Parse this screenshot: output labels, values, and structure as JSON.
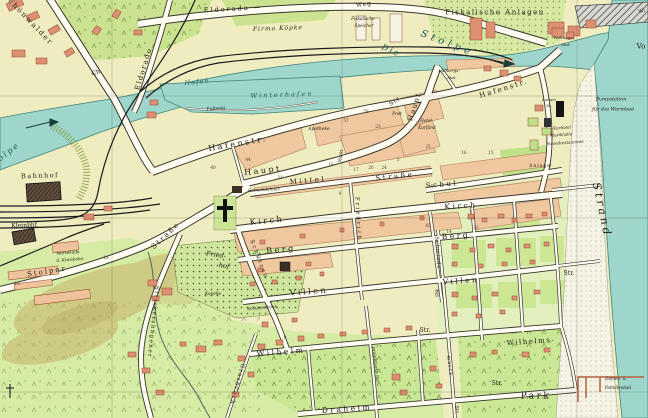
{
  "map": {
    "colors": {
      "land": "#efecc0",
      "water": "#9fd6cc",
      "park_green": "#cbe390",
      "meadow_green": "#d6eba4",
      "building_block": "#f0c8a0",
      "house_red": "#dd8f72",
      "beach": "#f6f3e4",
      "hill_tan": "#c8b26a",
      "rail_black": "#1c1c1c"
    },
    "labels": [
      {
        "t": "Schönwalder",
        "x": 28,
        "y": 20,
        "s": 7,
        "r": 46,
        "ls": 2,
        "n": "label-schoenwalder-ch"
      },
      {
        "t": "Ch.",
        "x": 97,
        "y": 73,
        "s": 6,
        "r": -20,
        "n": "label-chaussee-abbrev"
      },
      {
        "t": "Eldorado",
        "x": 144,
        "y": 69,
        "s": 7,
        "r": -73,
        "ls": 1.5,
        "n": "label-eldorado-street"
      },
      {
        "t": "Eldorado —",
        "x": 233,
        "y": 9,
        "s": 6.5,
        "r": -3,
        "ls": 2,
        "n": "label-eldoradoweg-1"
      },
      {
        "t": "Weg",
        "x": 364,
        "y": 5,
        "s": 6,
        "r": -8,
        "ls": 1,
        "n": "label-eldoradoweg-2"
      },
      {
        "t": "Firma Köpke",
        "x": 278,
        "y": 29,
        "s": 6,
        "r": -2,
        "c": "it",
        "ls": 1,
        "n": "label-firma-koepke"
      },
      {
        "t": "Fiskalische",
        "x": 363,
        "y": 19,
        "s": 4.2,
        "c": "it",
        "n": "label-fisk-speicher-1"
      },
      {
        "t": "Speicher",
        "x": 364,
        "y": 26,
        "s": 4.2,
        "c": "it",
        "n": "label-fisk-speicher-2"
      },
      {
        "t": "Fiskalische Anlagen",
        "x": 495,
        "y": 13,
        "s": 7,
        "ls": 1.5,
        "n": "label-fiskalische-anlagen"
      },
      {
        "t": "Rettungs-",
        "x": 564,
        "y": 38,
        "s": 4,
        "c": "it",
        "n": "label-rettungs-stat-1"
      },
      {
        "t": "Stat.",
        "x": 566,
        "y": 45,
        "s": 4,
        "c": "it",
        "n": "label-rettungs-stat-2"
      },
      {
        "t": "Wi",
        "x": 642,
        "y": 12,
        "s": 5,
        "r": -15,
        "n": "label-edge-wi"
      },
      {
        "t": "Vo",
        "x": 641,
        "y": 47,
        "s": 7,
        "n": "label-edge-vo"
      },
      {
        "t": "Die",
        "x": 391,
        "y": 51,
        "s": 8,
        "r": 24,
        "c": "wat",
        "ls": 2,
        "n": "label-die-stolpe-1"
      },
      {
        "t": "Stolpe",
        "x": 447,
        "y": 44,
        "s": 10,
        "r": 21,
        "c": "wat",
        "ls": 4,
        "n": "label-die-stolpe-2"
      },
      {
        "t": "Hallbergs-",
        "x": 449,
        "y": 71,
        "s": 4,
        "c": "it",
        "n": "label-hallbergs-stat-1"
      },
      {
        "t": "Stat.",
        "x": 452,
        "y": 78,
        "s": 4,
        "c": "it",
        "n": "label-hallbergs-stat-2"
      },
      {
        "t": "Hafenstr.",
        "x": 504,
        "y": 89,
        "s": 7,
        "r": -17,
        "ls": 2,
        "n": "label-hafenstr-east"
      },
      {
        "t": "Stolpe",
        "x": 4,
        "y": 156,
        "s": 8,
        "r": -38,
        "c": "wat",
        "ls": 2,
        "n": "label-stolpe-west"
      },
      {
        "t": "Hafen",
        "x": 197,
        "y": 82,
        "s": 6.5,
        "r": -6,
        "c": "wat",
        "ls": 1,
        "n": "label-hafen"
      },
      {
        "t": "Winterhafen",
        "x": 282,
        "y": 95,
        "s": 6.5,
        "r": -2,
        "c": "wat",
        "ls": 2,
        "n": "label-winterhafen"
      },
      {
        "t": "Fußweg",
        "x": 216,
        "y": 110,
        "s": 4.5,
        "r": -4,
        "n": "label-fussweg"
      },
      {
        "t": "Hafenstr.",
        "x": 238,
        "y": 144,
        "s": 8,
        "r": -10,
        "ls": 2.5,
        "n": "label-hafenstr-west"
      },
      {
        "t": "Haupt",
        "x": 263,
        "y": 171,
        "s": 8,
        "r": -7,
        "ls": 2.5,
        "n": "label-hauptstr-west"
      },
      {
        "t": "Str.",
        "x": 396,
        "y": 101,
        "s": 6,
        "r": -35,
        "ls": 1,
        "n": "label-str-ne"
      },
      {
        "t": "Haupt",
        "x": 415,
        "y": 107,
        "s": 7,
        "r": -72,
        "ls": 1.5,
        "n": "label-hauptstr-ne"
      },
      {
        "t": "Post",
        "x": 397,
        "y": 115,
        "s": 4.5,
        "c": "it",
        "n": "label-post"
      },
      {
        "t": "Apotheke",
        "x": 319,
        "y": 130,
        "s": 4.5,
        "c": "it",
        "n": "label-apotheke"
      },
      {
        "t": "Hotel",
        "x": 426,
        "y": 121,
        "s": 4.2,
        "c": "it",
        "n": "label-hotel-1"
      },
      {
        "t": "Kurfürst",
        "x": 427,
        "y": 128,
        "s": 4.2,
        "c": "it",
        "n": "label-hotel-2"
      },
      {
        "t": "Markt",
        "x": 341,
        "y": 156,
        "s": 4.2,
        "r": -80,
        "n": "label-markt"
      },
      {
        "t": "Gemeindehaus",
        "x": 264,
        "y": 190,
        "s": 4.2,
        "r": -3,
        "c": "it",
        "n": "label-gemeindehaus"
      },
      {
        "t": "Mittel",
        "x": 308,
        "y": 181,
        "s": 7,
        "r": -5,
        "ls": 2.5,
        "n": "label-mittelstr-1"
      },
      {
        "t": "Straße",
        "x": 395,
        "y": 177,
        "s": 7,
        "r": -6,
        "ls": 2.5,
        "n": "label-mittelstr-2"
      },
      {
        "t": "Schul",
        "x": 442,
        "y": 185,
        "s": 7,
        "r": -5,
        "ls": 2.5,
        "n": "label-schulstr"
      },
      {
        "t": "Kirch",
        "x": 267,
        "y": 221,
        "s": 8,
        "r": -6,
        "ls": 2.5,
        "n": "label-kirchstr-west"
      },
      {
        "t": "Kirch",
        "x": 461,
        "y": 206,
        "s": 7.5,
        "r": -4,
        "ls": 2.5,
        "n": "label-kirchstr-east"
      },
      {
        "t": "Berg",
        "x": 281,
        "y": 250,
        "s": 8,
        "r": -6,
        "ls": 2.5,
        "n": "label-bergstr-west"
      },
      {
        "t": "Berg",
        "x": 456,
        "y": 236,
        "s": 7.5,
        "r": -4,
        "ls": 2.5,
        "n": "label-bergstr-east"
      },
      {
        "t": "Villen",
        "x": 309,
        "y": 292,
        "s": 8,
        "r": -5,
        "ls": 2.5,
        "n": "label-villenstr-west"
      },
      {
        "t": "Villen",
        "x": 461,
        "y": 281,
        "s": 7.5,
        "r": -4,
        "ls": 2.5,
        "n": "label-villenstr-east"
      },
      {
        "t": "Wilhelm",
        "x": 281,
        "y": 352,
        "s": 7.5,
        "r": -5,
        "ls": 2.5,
        "n": "label-wilhelmstr"
      },
      {
        "t": "Wilhelms-",
        "x": 531,
        "y": 342,
        "s": 7,
        "r": -4,
        "ls": 1.5,
        "n": "label-wilhelms"
      },
      {
        "t": "Draheim",
        "x": 347,
        "y": 409,
        "s": 7.5,
        "r": -4,
        "ls": 2.5,
        "n": "label-draheimstr"
      },
      {
        "t": "Park",
        "x": 536,
        "y": 397,
        "s": 9,
        "ls": 2.5,
        "n": "label-park"
      },
      {
        "t": "Str.",
        "x": 497,
        "y": 384,
        "s": 6,
        "n": "label-str-se"
      },
      {
        "t": "Str.",
        "x": 425,
        "y": 331,
        "s": 6,
        "n": "label-str-mid"
      },
      {
        "t": "Str.",
        "x": 569,
        "y": 274,
        "s": 6,
        "n": "label-str-east"
      },
      {
        "t": "Str.",
        "x": 456,
        "y": 410,
        "s": 5,
        "r": 84,
        "n": "label-str-corner"
      },
      {
        "t": "projektierte Str.",
        "x": 374,
        "y": 365,
        "s": 4.5,
        "r": 84,
        "n": "label-projektierte-str"
      },
      {
        "t": "Friedrich",
        "x": 357,
        "y": 219,
        "s": 5.5,
        "r": 87,
        "ls": 2,
        "n": "label-friedrichstr"
      },
      {
        "t": "Schützen",
        "x": 258,
        "y": 260,
        "s": 5.5,
        "r": 69,
        "ls": 2,
        "n": "label-schuetzenstr"
      },
      {
        "t": "Schmiede",
        "x": 437,
        "y": 253,
        "s": 5,
        "r": 86,
        "ls": 1,
        "n": "label-schmiedestr"
      },
      {
        "t": "Bis",
        "x": 436,
        "y": 293,
        "s": 5,
        "r": 86,
        "n": "label-bismarck-1"
      },
      {
        "t": "marck",
        "x": 449,
        "y": 366,
        "s": 5,
        "r": 83,
        "ls": 1,
        "n": "label-bismarck-2"
      },
      {
        "t": "Grasbruch",
        "x": 236,
        "y": 384,
        "s": 5.5,
        "r": 105,
        "ls": 1.5,
        "n": "label-grasbruch"
      },
      {
        "t": "Strickershagener",
        "x": 152,
        "y": 322,
        "s": 5.5,
        "r": 96,
        "ls": 1.5,
        "n": "label-strickershagener"
      },
      {
        "t": "Stolper",
        "x": 47,
        "y": 272,
        "s": 7,
        "r": -9,
        "ls": 2,
        "n": "label-stolper-str-1"
      },
      {
        "t": "Straße",
        "x": 166,
        "y": 236,
        "s": 7,
        "r": -43,
        "ls": 2,
        "n": "label-stolper-str-2"
      },
      {
        "t": "Bahnhof",
        "x": 40,
        "y": 176,
        "s": 6.5,
        "r": -2,
        "ls": 1.5,
        "n": "label-bahnhof"
      },
      {
        "t": "Kleinbhf.",
        "x": 25,
        "y": 226,
        "s": 6,
        "r": -2,
        "n": "label-kleinbahnhof"
      },
      {
        "t": "Wartehalle",
        "x": 68,
        "y": 253,
        "s": 4.2,
        "r": -4,
        "c": "it",
        "n": "label-wartehalle-1"
      },
      {
        "t": "d. Kreisbahn",
        "x": 70,
        "y": 260,
        "s": 4.2,
        "r": -4,
        "c": "it",
        "n": "label-wartehalle-2"
      },
      {
        "t": "Fried-",
        "x": 216,
        "y": 255,
        "s": 6.5,
        "r": 8,
        "c": "it",
        "n": "label-friedhof-1"
      },
      {
        "t": "hof",
        "x": 224,
        "y": 266,
        "s": 6.5,
        "r": 8,
        "c": "it",
        "n": "label-friedhof-2"
      },
      {
        "t": "Kapelle",
        "x": 213,
        "y": 294,
        "s": 4.2,
        "c": "it",
        "n": "label-kapelle"
      },
      {
        "t": "Schützenhaus",
        "x": 262,
        "y": 308,
        "s": 4.2,
        "r": -5,
        "c": "it",
        "n": "label-schuetzenhaus"
      },
      {
        "t": "Anlage",
        "x": 540,
        "y": 167,
        "s": 4.5,
        "ls": 1,
        "n": "label-anlage"
      },
      {
        "t": "Lotsen",
        "x": 549,
        "y": 100,
        "s": 4,
        "c": "it",
        "n": "label-lotsen-1"
      },
      {
        "t": "St.",
        "x": 549,
        "y": 106,
        "s": 4,
        "c": "it",
        "n": "label-lotsen-2"
      },
      {
        "t": "Pumpstation",
        "x": 611,
        "y": 101,
        "s": 4.8,
        "c": "it",
        "n": "label-pumpstation-1"
      },
      {
        "t": "für das Warmbad",
        "x": 613,
        "y": 111,
        "s": 4.8,
        "c": "it",
        "n": "label-pumpstation-2"
      },
      {
        "t": "Kurhotel",
        "x": 562,
        "y": 128,
        "s": 4,
        "r": -4,
        "c": "it",
        "n": "label-kurhotel"
      },
      {
        "t": "Musikhalle",
        "x": 561,
        "y": 135,
        "s": 4,
        "r": -4,
        "c": "it",
        "n": "label-musikhalle"
      },
      {
        "t": "Strandrestaurants",
        "x": 565,
        "y": 143,
        "s": 4,
        "r": -4,
        "c": "it",
        "n": "label-strandrestaurants"
      },
      {
        "t": "Damen- u.",
        "x": 616,
        "y": 379,
        "s": 4.2,
        "c": "it",
        "n": "label-familienbad-1"
      },
      {
        "t": "Familienbad",
        "x": 618,
        "y": 388,
        "s": 4.2,
        "c": "it",
        "n": "label-familienbad-2"
      },
      {
        "t": "Strand",
        "x": 602,
        "y": 210,
        "s": 11,
        "r": 78,
        "c": "it",
        "ls": 3,
        "n": "label-strand"
      }
    ],
    "house_numbers": [
      {
        "t": "40",
        "x": 213,
        "y": 168
      },
      {
        "t": "44",
        "x": 248,
        "y": 160
      },
      {
        "t": "57",
        "x": 346,
        "y": 121
      },
      {
        "t": "58",
        "x": 366,
        "y": 112
      },
      {
        "t": "23",
        "x": 378,
        "y": 127
      },
      {
        "t": "25",
        "x": 428,
        "y": 147
      },
      {
        "t": "31",
        "x": 280,
        "y": 178
      },
      {
        "t": "16",
        "x": 331,
        "y": 165
      },
      {
        "t": "17",
        "x": 356,
        "y": 170
      },
      {
        "t": "20",
        "x": 371,
        "y": 168
      },
      {
        "t": "24",
        "x": 384,
        "y": 168
      },
      {
        "t": "16",
        "x": 464,
        "y": 153
      },
      {
        "t": "15",
        "x": 491,
        "y": 153
      },
      {
        "t": "5",
        "x": 432,
        "y": 187
      },
      {
        "t": "13",
        "x": 476,
        "y": 228
      },
      {
        "t": "14",
        "x": 449,
        "y": 232
      },
      {
        "t": "18",
        "x": 106,
        "y": 258
      },
      {
        "t": "12",
        "x": 17,
        "y": 284
      },
      {
        "t": "8",
        "x": 285,
        "y": 338
      },
      {
        "t": "9",
        "x": 340,
        "y": 194
      },
      {
        "t": "45",
        "x": 428,
        "y": 226
      },
      {
        "t": "3",
        "x": 398,
        "y": 160
      }
    ]
  }
}
